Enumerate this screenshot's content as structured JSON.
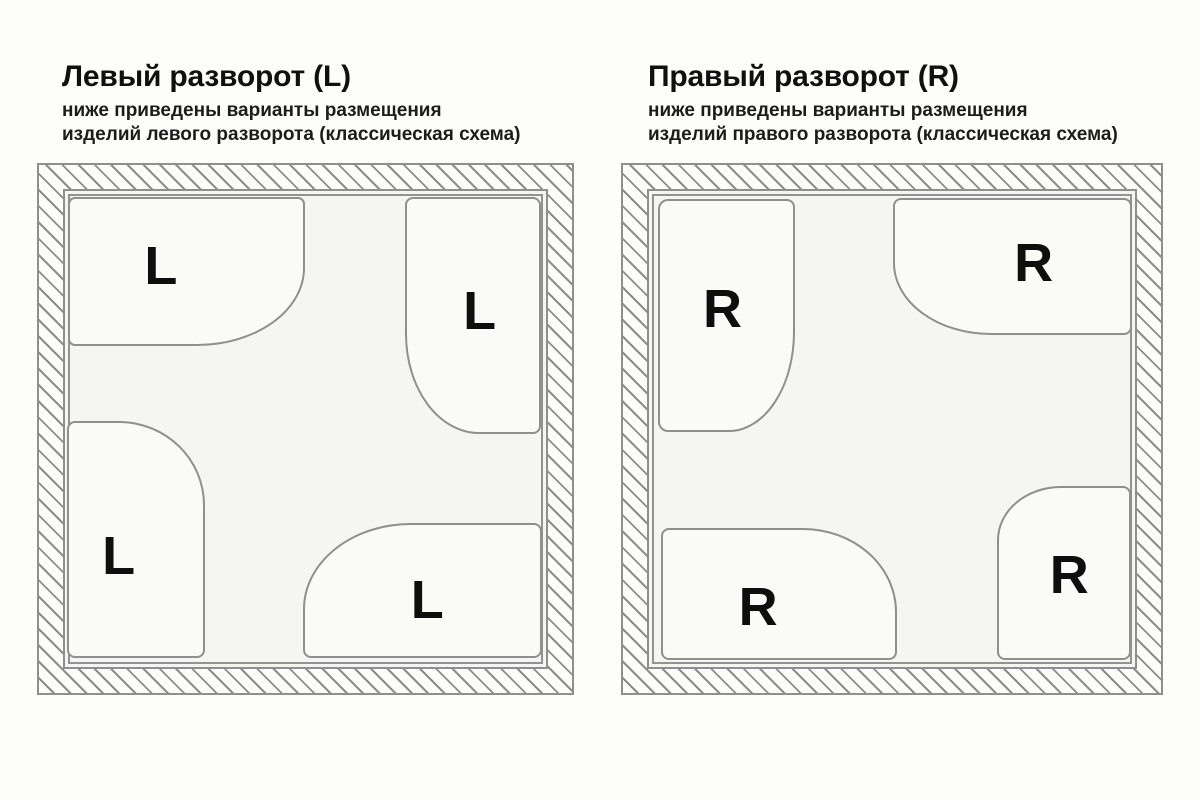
{
  "diagram": {
    "type": "bathroom-layout-scheme",
    "colors": {
      "background": "#fdfdfc",
      "room_fill": "#f5f5f2",
      "tray_fill": "#fafaf7",
      "outline": "#8f8f8f",
      "hatch": "#8d8d8d",
      "text": "#111111"
    }
  },
  "panels": [
    {
      "id": "left",
      "title": "Левый разворот (L)",
      "subtitle_line1": "ниже приведены варианты размещения",
      "subtitle_line2": "изделий левого разворота (классическая схема)",
      "orientation": "L",
      "trays": [
        {
          "position": "top-left",
          "shape": "landscape",
          "curved_corner": "bottom-right",
          "label": "L"
        },
        {
          "position": "top-right",
          "shape": "portrait",
          "curved_corner": "bottom-left",
          "label": "L"
        },
        {
          "position": "bottom-left",
          "shape": "portrait",
          "curved_corner": "top-right",
          "label": "L"
        },
        {
          "position": "bottom-right",
          "shape": "landscape",
          "curved_corner": "top-left",
          "label": "L"
        }
      ]
    },
    {
      "id": "right",
      "title": "Правый разворот (R)",
      "subtitle_line1": "ниже приведены варианты размещения",
      "subtitle_line2": "изделий правого разворота (классическая схема)",
      "orientation": "R",
      "trays": [
        {
          "position": "top-left",
          "shape": "portrait",
          "curved_corner": "bottom-right",
          "label": "R"
        },
        {
          "position": "top-right",
          "shape": "landscape",
          "curved_corner": "bottom-left",
          "label": "R"
        },
        {
          "position": "bottom-left",
          "shape": "landscape",
          "curved_corner": "top-right",
          "label": "R"
        },
        {
          "position": "bottom-right",
          "shape": "portrait",
          "curved_corner": "top-left",
          "label": "R"
        }
      ]
    }
  ]
}
